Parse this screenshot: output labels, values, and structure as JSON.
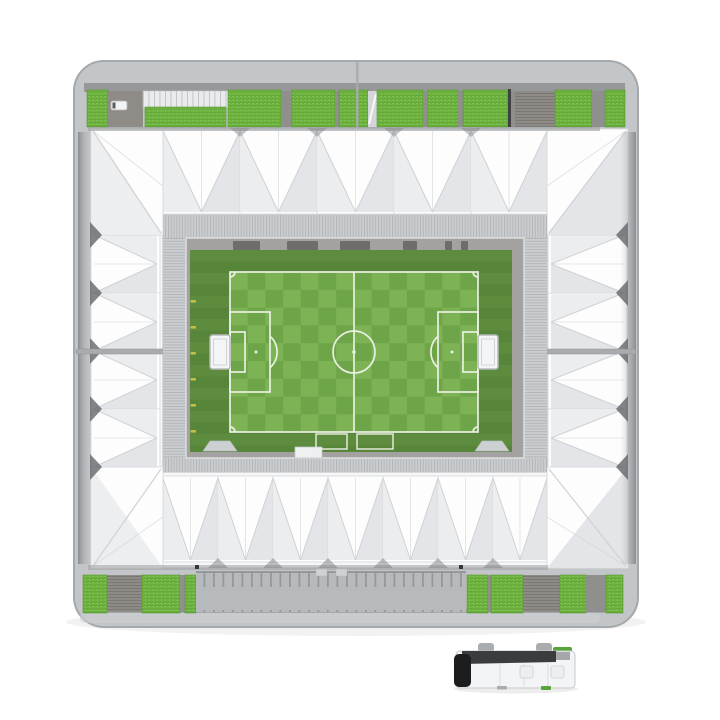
{
  "scene": {
    "type": "product-photo",
    "subject": "3D puzzle football stadium model, aerial top view, with miniature team coach bus at bottom right",
    "background": "#ffffff",
    "components": [
      "stadium-model",
      "team-bus-model"
    ]
  },
  "colors": {
    "base": "#c3c6c8",
    "base-edge": "#a6a9ab",
    "base-rim": "#cdd0d2",
    "backdrop": "#96989a",
    "stand-green": "#6aaf3c",
    "stand-green-dot": "#8ecb60",
    "stand-green-edge": "#58982f",
    "aisle": "#8f908e",
    "aisle-light": "#d4d6d8",
    "ramp": "#8f8b86",
    "stairs-bg": "#8e8b87",
    "stairs-line": "#7b7874",
    "deck-bg": "#e9ebec",
    "deck-line": "#bfc2c4",
    "band-bg": "#b7babc",
    "band-tick": "#95989a",
    "roof-base": "#f6f7f8",
    "roof-bright": "#fdfdfe",
    "roof-shade": "#e9ebed",
    "roof-shade2": "#e0e2e5",
    "crease": "#cfd2d4",
    "panel-edge": "#d8dadc",
    "eave-shadow": "#63666a",
    "notch-shadow": "#7e8184",
    "roof-edge": "#c2c5c7",
    "hatch-bg": "#cbced0",
    "hatch-line": "#b2b5b7",
    "wall": "#a3a2a0",
    "curb": "#dddfe0",
    "dugout": "#6e6d6b",
    "grass-dark1": "#57853a",
    "grass-dark2": "#5d8c3e",
    "pitch-light": "#7db355",
    "pitch-dark": "#6fa549",
    "line-white": "#eaf0e4",
    "goal-fill": "#f4f5f6",
    "goal-edge": "#b6b9bb",
    "tick-yellow": "#d8c84a",
    "seam": "#a9acae",
    "shadow-line": "#9ea1a3",
    "bus-body": "#f3f4f5",
    "bus-edge": "#c6c9cb",
    "bus-glass-dark": "#3a3c3e",
    "bus-front": "#1b1d1f",
    "bus-green": "#57a439",
    "bus-wheel": "#aaadaf",
    "bus-panel": "#d9dbdd"
  },
  "stadium": {
    "top_stands": [
      {
        "t": "green",
        "x": 87,
        "w": 21
      },
      {
        "t": "ramp",
        "x": 108,
        "w": 35
      },
      {
        "t": "deck",
        "x": 143,
        "w": 85
      },
      {
        "t": "green",
        "x": 228,
        "w": 53
      },
      {
        "t": "aisle",
        "x": 281,
        "w": 11
      },
      {
        "t": "green",
        "x": 292,
        "w": 43
      },
      {
        "t": "aisle",
        "x": 335,
        "w": 4
      },
      {
        "t": "green",
        "x": 339,
        "w": 29
      },
      {
        "t": "aisleLight",
        "x": 368,
        "w": 9
      },
      {
        "t": "green",
        "x": 377,
        "w": 46
      },
      {
        "t": "aisle",
        "x": 423,
        "w": 5
      },
      {
        "t": "green",
        "x": 428,
        "w": 30
      },
      {
        "t": "aisle",
        "x": 458,
        "w": 5
      },
      {
        "t": "green",
        "x": 463,
        "w": 45
      },
      {
        "t": "seam",
        "x": 508,
        "w": 3
      },
      {
        "t": "aisle",
        "x": 511,
        "w": 4
      },
      {
        "t": "stairs",
        "x": 515,
        "w": 40
      },
      {
        "t": "green",
        "x": 555,
        "w": 37
      },
      {
        "t": "aisle",
        "x": 592,
        "w": 13
      },
      {
        "t": "green",
        "x": 605,
        "w": 20
      }
    ],
    "top_lower_tier": {
      "x": 477,
      "y": 129,
      "w": 35,
      "h": 12
    },
    "bottom_stands": [
      {
        "t": "green",
        "x": 83,
        "w": 24
      },
      {
        "t": "stairs",
        "x": 107,
        "w": 35
      },
      {
        "t": "green",
        "x": 142,
        "w": 38
      },
      {
        "t": "aisle",
        "x": 180,
        "w": 5
      },
      {
        "t": "green",
        "x": 185,
        "w": 11
      },
      {
        "t": "band",
        "x": 196,
        "w": 270
      },
      {
        "t": "green",
        "x": 467,
        "w": 21
      },
      {
        "t": "aisle",
        "x": 488,
        "w": 3
      },
      {
        "t": "green",
        "x": 491,
        "w": 32
      },
      {
        "t": "stairs",
        "x": 523,
        "w": 37
      },
      {
        "t": "green",
        "x": 560,
        "w": 26
      },
      {
        "t": "aisle",
        "x": 586,
        "w": 20
      },
      {
        "t": "green",
        "x": 606,
        "w": 17
      }
    ],
    "roof": {
      "top_boundaries": [
        163,
        240,
        317,
        394,
        471,
        547
      ],
      "bottom_boundaries": [
        163,
        218,
        273,
        328,
        383,
        438,
        493,
        547
      ],
      "left_boundaries": [
        235,
        293,
        351,
        409,
        467
      ],
      "right_boundaries": [
        235,
        293,
        351,
        409,
        467
      ]
    },
    "north_wall_boxes": [
      [
        233,
        27
      ],
      [
        287,
        31
      ],
      [
        340,
        30
      ],
      [
        403,
        14
      ],
      [
        445,
        7
      ],
      [
        461,
        7
      ]
    ],
    "west_wall_tick_ys": [
      300,
      326,
      352,
      378,
      404,
      430
    ]
  }
}
